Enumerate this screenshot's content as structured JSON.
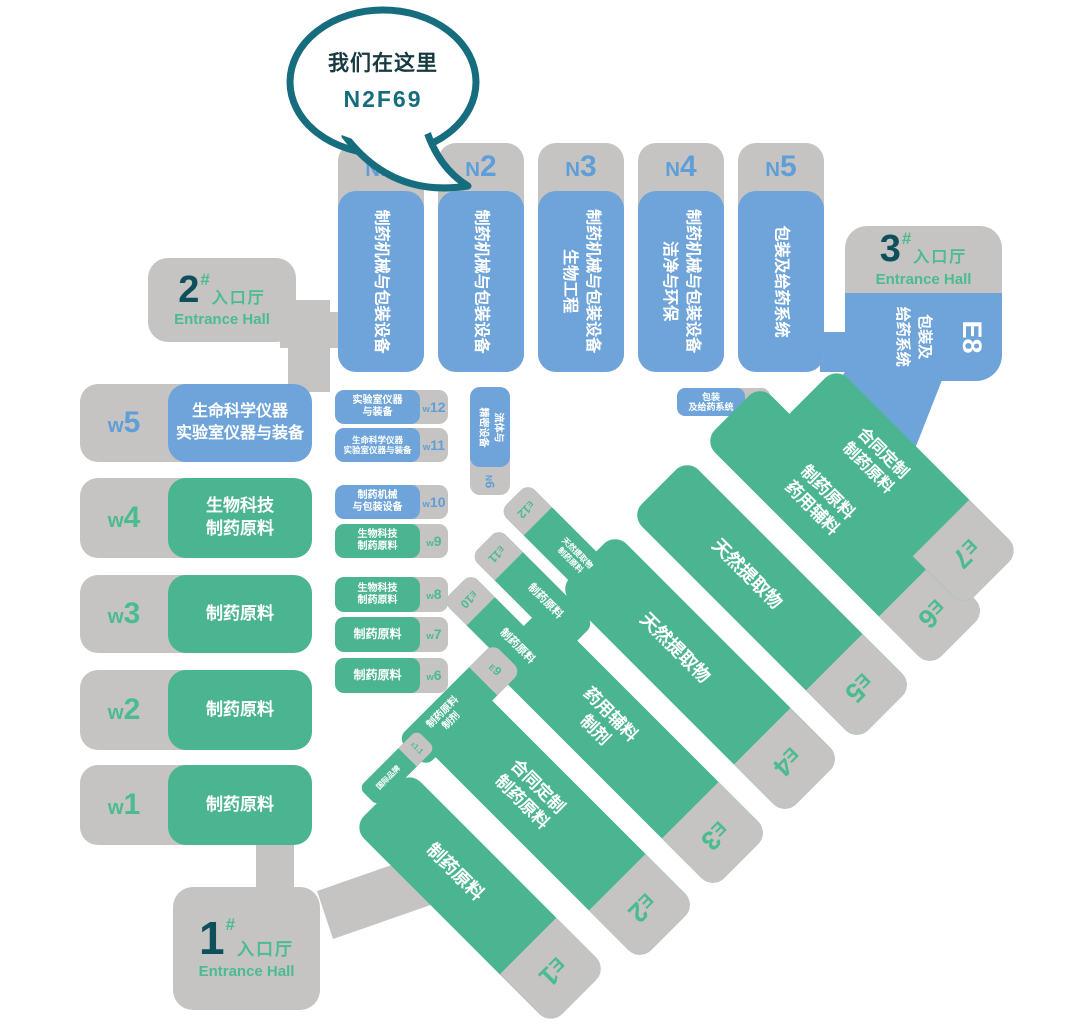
{
  "bubble": {
    "line1": "我们在这里",
    "line2": "N2F69"
  },
  "entrances": [
    {
      "num": "1",
      "hash": "#",
      "cn": "入口厅",
      "en": "Entrance Hall"
    },
    {
      "num": "2",
      "hash": "#",
      "cn": "入口厅",
      "en": "Entrance Hall"
    },
    {
      "num": "3",
      "hash": "#",
      "cn": "入口厅",
      "en": "Entrance Hall"
    }
  ],
  "north_halls": [
    {
      "id": "N1",
      "lines": [
        "制药机械与包装设备"
      ]
    },
    {
      "id": "N2",
      "lines": [
        "制药机械与包装设备"
      ]
    },
    {
      "id": "N3",
      "lines": [
        "制药机械与包装设备",
        "生物工程"
      ]
    },
    {
      "id": "N4",
      "lines": [
        "制药机械与包装设备",
        "洁净与环保"
      ]
    },
    {
      "id": "N5",
      "lines": [
        "包装及给药系统"
      ]
    }
  ],
  "n6": {
    "id": "N6",
    "lines": [
      "流体与",
      "精密设备"
    ]
  },
  "n7": {
    "id": "N7",
    "lines": [
      "包装",
      "及给药系统"
    ]
  },
  "e8": {
    "id": "E8",
    "lines": [
      "包装及",
      "给药系统"
    ]
  },
  "west_large": [
    {
      "id": "w5",
      "lines": [
        "生命科学仪器",
        "实验室仪器与装备"
      ],
      "color": "blue"
    },
    {
      "id": "w4",
      "lines": [
        "生物科技",
        "制药原料"
      ],
      "color": "green"
    },
    {
      "id": "w3",
      "lines": [
        "制药原料"
      ],
      "color": "green"
    },
    {
      "id": "w2",
      "lines": [
        "制药原料"
      ],
      "color": "green"
    },
    {
      "id": "w1",
      "lines": [
        "制药原料"
      ],
      "color": "green"
    }
  ],
  "west_small": [
    {
      "id": "w12",
      "lines": [
        "实验室仪器",
        "与装备"
      ],
      "color": "blue"
    },
    {
      "id": "w11",
      "lines": [
        "生命科学仪器",
        "实验室仪器与装备"
      ],
      "color": "blue"
    },
    {
      "id": "w10",
      "lines": [
        "制药机械",
        "与包装设备"
      ],
      "color": "blue"
    },
    {
      "id": "w9",
      "lines": [
        "生物科技",
        "制药原料"
      ],
      "color": "green"
    },
    {
      "id": "w8",
      "lines": [
        "生物科技",
        "制药原料"
      ],
      "color": "green"
    },
    {
      "id": "w7",
      "lines": [
        "制药原料"
      ],
      "color": "green"
    },
    {
      "id": "w6",
      "lines": [
        "制药原料"
      ],
      "color": "green"
    }
  ],
  "east_large": [
    {
      "id": "E1",
      "lines": [
        "制药原料"
      ]
    },
    {
      "id": "E2",
      "lines": [
        "合同定制",
        "制药原料"
      ]
    },
    {
      "id": "E3",
      "lines": [
        "药用辅料",
        "制剂"
      ]
    },
    {
      "id": "E4",
      "lines": [
        "天然提取物"
      ]
    },
    {
      "id": "E5",
      "lines": [
        "天然提取物"
      ]
    },
    {
      "id": "E6",
      "lines": [
        "制药原料",
        "药用辅料"
      ]
    },
    {
      "id": "E7",
      "lines": [
        "合同定制",
        "制药原料"
      ]
    }
  ],
  "east_small": [
    {
      "id": "E12",
      "lines": [
        "天然提取物",
        "制药原料"
      ]
    },
    {
      "id": "E11",
      "lines": [
        "制药原料"
      ]
    },
    {
      "id": "E10",
      "lines": [
        "制药原料"
      ]
    },
    {
      "id": "E9",
      "lines": [
        "制药原料",
        "制剂"
      ]
    },
    {
      "id": "E1.1",
      "lines": [
        "国际品牌"
      ]
    }
  ],
  "colors": {
    "blue": "#6ea4d9",
    "green": "#4bb591",
    "gray": "#c5c4c2",
    "blue-text": "#5f9ed8",
    "green-text": "#4bbb90",
    "teal-dark": "#0e4f5c",
    "bubble-stroke": "#166d7d",
    "bubble-text": "#173a41",
    "white": "#ffffff"
  }
}
